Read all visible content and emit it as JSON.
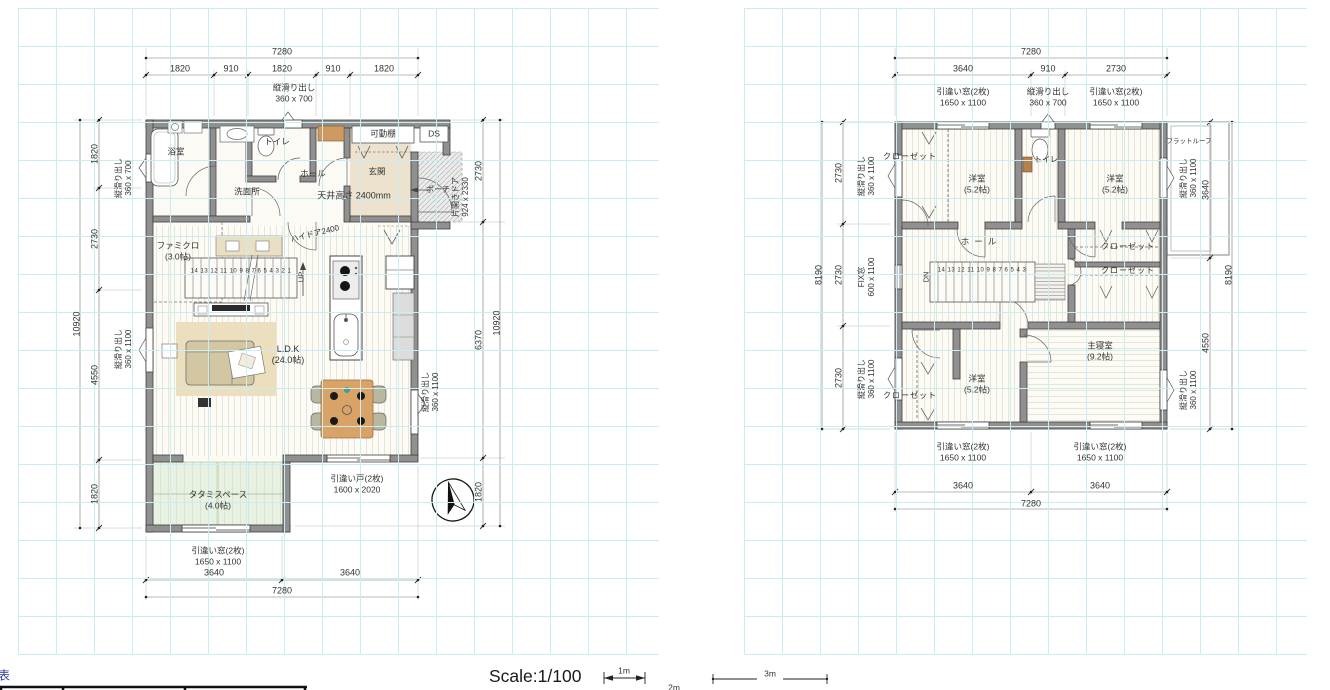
{
  "colors": {
    "grid": "#c9edf0",
    "wall_fill": "#909090",
    "wall_stroke": "#3f3f3f",
    "tatami": "#e9f2e2",
    "wood_floor": "#fcfbf6",
    "table_wood": "#d9a368",
    "dim_text": "#333333"
  },
  "floor1_labels": [
    {
      "name": "f1-dim-top-total",
      "text": "7280",
      "x": 282,
      "y": 52
    },
    {
      "name": "f1-dim-top-1",
      "text": "1820",
      "x": 180,
      "y": 69
    },
    {
      "name": "f1-dim-top-2",
      "text": "910",
      "x": 231,
      "y": 69
    },
    {
      "name": "f1-dim-top-3",
      "text": "1820",
      "x": 282,
      "y": 69
    },
    {
      "name": "f1-dim-top-4",
      "text": "910",
      "x": 333,
      "y": 69
    },
    {
      "name": "f1-dim-top-5",
      "text": "1820",
      "x": 384,
      "y": 69
    },
    {
      "name": "f1-window-label-top",
      "text": "縦滑り出し\n360 x 700",
      "x": 294,
      "y": 93,
      "size": 8.5
    },
    {
      "name": "f1-label-movable-shelf",
      "text": "可動棚",
      "x": 383,
      "y": 134,
      "size": 8.5
    },
    {
      "name": "f1-label-ds",
      "text": "DS",
      "x": 434,
      "y": 134,
      "size": 8.5
    },
    {
      "name": "f1-room-bath",
      "text": "浴室",
      "x": 176,
      "y": 152,
      "size": 8.5
    },
    {
      "name": "f1-room-toilet",
      "text": "トイレ",
      "x": 277,
      "y": 142,
      "size": 8.5
    },
    {
      "name": "f1-room-hall",
      "text": "ホール",
      "x": 313,
      "y": 174,
      "size": 8.5
    },
    {
      "name": "f1-room-entrance",
      "text": "玄関",
      "x": 377,
      "y": 172,
      "size": 8.5
    },
    {
      "name": "f1-room-washroom",
      "text": "洗面所",
      "x": 247,
      "y": 192,
      "size": 8.5
    },
    {
      "name": "f1-label-ceiling-height",
      "text": "天井高さ 2400mm",
      "x": 354,
      "y": 196,
      "size": 9
    },
    {
      "name": "f1-label-porch",
      "text": "ポーチ",
      "x": 438,
      "y": 190,
      "size": 8
    },
    {
      "name": "f1-label-entry-door",
      "text": "片開きドア\n924 x 2330",
      "x": 461,
      "y": 197,
      "rot": -90,
      "size": 8
    },
    {
      "name": "f1-dim-right-1",
      "text": "2730",
      "x": 479,
      "y": 171,
      "rot": -90
    },
    {
      "name": "f1-dim-right-2",
      "text": "6370",
      "x": 479,
      "y": 340,
      "rot": -90
    },
    {
      "name": "f1-dim-right-3",
      "text": "1820",
      "x": 479,
      "y": 492,
      "rot": -90
    },
    {
      "name": "f1-dim-right-total",
      "text": "10920",
      "x": 497,
      "y": 323,
      "rot": -90
    },
    {
      "name": "f1-window-label-left-top",
      "text": "縦滑り出し\n360 x 700",
      "x": 124,
      "y": 178,
      "rot": -90,
      "size": 8
    },
    {
      "name": "f1-window-label-left-mid",
      "text": "縦滑り出し\n360 x 1100",
      "x": 124,
      "y": 349,
      "rot": -90,
      "size": 8
    },
    {
      "name": "f1-dim-left-1",
      "text": "1820",
      "x": 95,
      "y": 154,
      "rot": -90
    },
    {
      "name": "f1-dim-left-2",
      "text": "2730",
      "x": 95,
      "y": 239,
      "rot": -90
    },
    {
      "name": "f1-dim-left-3",
      "text": "4550",
      "x": 95,
      "y": 375,
      "rot": -90
    },
    {
      "name": "f1-dim-left-4",
      "text": "1820",
      "x": 95,
      "y": 494,
      "rot": -90
    },
    {
      "name": "f1-dim-left-total",
      "text": "10920",
      "x": 77,
      "y": 324,
      "rot": -90
    },
    {
      "name": "f1-room-family-closet",
      "text": "ファミクロ\n(3.0帖)",
      "x": 178,
      "y": 251,
      "size": 8.5
    },
    {
      "name": "f1-stair-numbers",
      "text": "14 13 12 11 10 9 8 7 6 5 4 3 2 1",
      "x": 241,
      "y": 272,
      "size": 6,
      "ls": 0.5
    },
    {
      "name": "f1-stair-up",
      "text": "UP",
      "x": 301,
      "y": 277,
      "rot": -90,
      "size": 7.5
    },
    {
      "name": "f1-label-high-door",
      "text": "ハイドア2400",
      "x": 315,
      "y": 234,
      "rot": -14,
      "size": 8
    },
    {
      "name": "f1-room-ldk",
      "text": "L.D.K\n(24.0帖)",
      "x": 288,
      "y": 355,
      "size": 9
    },
    {
      "name": "f1-window-label-right",
      "text": "縦滑り出し\n360 x 1100",
      "x": 431,
      "y": 392,
      "rot": -90,
      "size": 8
    },
    {
      "name": "f1-room-tatami",
      "text": "タタミスペース\n(4.0帖)",
      "x": 218,
      "y": 500,
      "size": 8.5
    },
    {
      "name": "f1-label-sliding-door",
      "text": "引違い戸(2枚)\n1600 x 2020",
      "x": 357,
      "y": 484,
      "size": 8.5
    },
    {
      "name": "f1-window-label-bottom",
      "text": "引違い窓(2枚)\n1650 x 1100",
      "x": 218,
      "y": 556,
      "size": 8.5
    },
    {
      "name": "f1-dim-bottom-1",
      "text": "3640",
      "x": 214,
      "y": 573
    },
    {
      "name": "f1-dim-bottom-2",
      "text": "3640",
      "x": 350,
      "y": 573
    },
    {
      "name": "f1-dim-bottom-total",
      "text": "7280",
      "x": 282,
      "y": 591
    }
  ],
  "floor2_labels": [
    {
      "name": "f2-dim-top-total",
      "text": "7280",
      "x": 1031,
      "y": 52
    },
    {
      "name": "f2-dim-top-1",
      "text": "3640",
      "x": 963,
      "y": 69
    },
    {
      "name": "f2-dim-top-2",
      "text": "910",
      "x": 1048,
      "y": 69
    },
    {
      "name": "f2-dim-top-3",
      "text": "2730",
      "x": 1116,
      "y": 69
    },
    {
      "name": "f2-window-label-top-1",
      "text": "引違い窓(2枚)\n1650 x 1100",
      "x": 963,
      "y": 97,
      "size": 8.5
    },
    {
      "name": "f2-window-label-top-2",
      "text": "縦滑り出し\n360 x 700",
      "x": 1048,
      "y": 97,
      "size": 8.5
    },
    {
      "name": "f2-window-label-top-3",
      "text": "引違い窓(2枚)\n1650 x 1100",
      "x": 1116,
      "y": 97,
      "size": 8.5
    },
    {
      "name": "f2-room-closet-nw",
      "text": "クローゼット",
      "x": 910,
      "y": 157,
      "size": 8,
      "ls": 1
    },
    {
      "name": "f2-room-bedroom-nw",
      "text": "洋室\n(5.2帖)",
      "x": 977,
      "y": 184,
      "size": 8.5
    },
    {
      "name": "f2-room-toilet",
      "text": "トイレ",
      "x": 1046,
      "y": 160,
      "size": 8
    },
    {
      "name": "f2-room-bedroom-ne",
      "text": "洋室\n(5.2帖)",
      "x": 1115,
      "y": 184,
      "size": 8.5
    },
    {
      "name": "f2-label-flat-roof",
      "text": "フラットルーフ",
      "x": 1189,
      "y": 142,
      "size": 6.5
    },
    {
      "name": "f2-room-hall",
      "text": "ホール",
      "x": 981,
      "y": 242,
      "size": 8.5,
      "ls": 5
    },
    {
      "name": "f2-stair-dn",
      "text": "DN",
      "x": 926,
      "y": 277,
      "rot": -90,
      "size": 7.5
    },
    {
      "name": "f2-stair-numbers",
      "text": "14 13 12 11 10 9 8 7 6 5 4 3",
      "x": 982,
      "y": 271,
      "size": 6,
      "ls": 0.5
    },
    {
      "name": "f2-room-closet-e1",
      "text": "クローゼット",
      "x": 1128,
      "y": 247,
      "size": 8,
      "ls": 1
    },
    {
      "name": "f2-room-closet-e2",
      "text": "クローゼット",
      "x": 1128,
      "y": 271,
      "size": 8,
      "ls": 1
    },
    {
      "name": "f2-room-master-bedroom",
      "text": "主寝室\n(9.2帖)",
      "x": 1100,
      "y": 351,
      "size": 8.5
    },
    {
      "name": "f2-room-bedroom-sw",
      "text": "洋室\n(5.2帖)",
      "x": 977,
      "y": 384,
      "size": 8.5
    },
    {
      "name": "f2-room-closet-sw",
      "text": "クローゼット",
      "x": 910,
      "y": 396,
      "size": 8,
      "ls": 1
    },
    {
      "name": "f2-window-label-bottom-1",
      "text": "引違い窓(2枚)\n1650 x 1100",
      "x": 963,
      "y": 452,
      "size": 8.5
    },
    {
      "name": "f2-window-label-bottom-2",
      "text": "引違い窓(2枚)\n1650 x 1100",
      "x": 1100,
      "y": 452,
      "size": 8.5
    },
    {
      "name": "f2-dim-bottom-1",
      "text": "3640",
      "x": 963,
      "y": 486
    },
    {
      "name": "f2-dim-bottom-2",
      "text": "3640",
      "x": 1100,
      "y": 486
    },
    {
      "name": "f2-dim-bottom-total",
      "text": "7280",
      "x": 1031,
      "y": 504
    },
    {
      "name": "f2-dim-left-1",
      "text": "2730",
      "x": 839,
      "y": 173,
      "rot": -90
    },
    {
      "name": "f2-dim-left-2",
      "text": "2730",
      "x": 839,
      "y": 275,
      "rot": -90
    },
    {
      "name": "f2-dim-left-3",
      "text": "2730",
      "x": 839,
      "y": 378,
      "rot": -90
    },
    {
      "name": "f2-dim-left-total",
      "text": "8190",
      "x": 819,
      "y": 275,
      "rot": -90
    },
    {
      "name": "f2-window-label-left-1",
      "text": "縦滑り出し\n360 x 1100",
      "x": 867,
      "y": 176,
      "rot": -90,
      "size": 8
    },
    {
      "name": "f2-window-label-left-2",
      "text": "FIX窓\n600 x 1100",
      "x": 867,
      "y": 277,
      "rot": -90,
      "size": 8
    },
    {
      "name": "f2-window-label-left-3",
      "text": "縦滑り出し\n360 x 1100",
      "x": 867,
      "y": 379,
      "rot": -90,
      "size": 8
    },
    {
      "name": "f2-dim-right-1",
      "text": "3640",
      "x": 1206,
      "y": 190,
      "rot": -90
    },
    {
      "name": "f2-dim-right-2",
      "text": "4550",
      "x": 1206,
      "y": 343,
      "rot": -90
    },
    {
      "name": "f2-dim-right-total",
      "text": "8190",
      "x": 1229,
      "y": 275,
      "rot": -90
    },
    {
      "name": "f2-window-label-right-1",
      "text": "縦滑り出し\n360 x 1100",
      "x": 1189,
      "y": 178,
      "rot": -90,
      "size": 8
    },
    {
      "name": "f2-window-label-right-2",
      "text": "縦滑り出し\n360 x 1100",
      "x": 1189,
      "y": 390,
      "rot": -90,
      "size": 8
    }
  ],
  "footer_labels": [
    {
      "name": "scale-label",
      "text": "Scale:1/100",
      "x": 489,
      "y": 677,
      "size": 17.5,
      "anchor": "left",
      "color": "#1a1a1a"
    },
    {
      "name": "scalebar-1m-label",
      "text": "1m",
      "x": 624,
      "y": 671,
      "size": 8.5
    },
    {
      "name": "scalebar-2m-label",
      "text": "2m",
      "x": 674,
      "y": 688,
      "size": 8.5
    },
    {
      "name": "scalebar-3m-label",
      "text": "3m",
      "x": 770,
      "y": 674,
      "size": 8.5
    },
    {
      "name": "legend-table-caption",
      "text": "表",
      "x": -2,
      "y": 676,
      "size": 12,
      "anchor": "left",
      "color": "#2a3b9e"
    }
  ]
}
